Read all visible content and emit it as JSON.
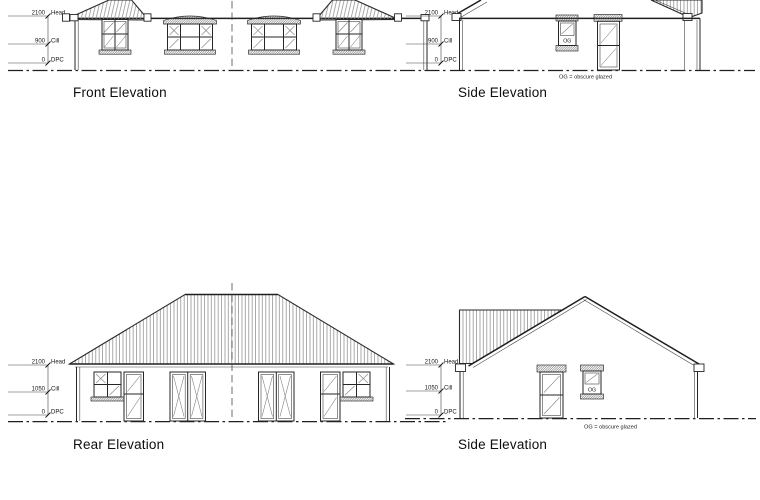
{
  "views": {
    "front": {
      "label": "Front Elevation",
      "dims": {
        "head": {
          "v": "2100",
          "n": "Head"
        },
        "cill": {
          "v": "900",
          "n": "Cill"
        },
        "dpc": {
          "v": "0",
          "n": "DPC"
        }
      }
    },
    "side_top": {
      "label": "Side Elevation",
      "dims": {
        "head": {
          "v": "2100",
          "n": "Head"
        },
        "cill": {
          "v": "900",
          "n": "Cill"
        },
        "dpc": {
          "v": "0",
          "n": "DPC"
        }
      },
      "og": "OG",
      "note": "OG = obscure glazed"
    },
    "rear": {
      "label": "Rear Elevation",
      "dims": {
        "head": {
          "v": "2100",
          "n": "Head"
        },
        "cill": {
          "v": "1050",
          "n": "Cill"
        },
        "dpc": {
          "v": "0",
          "n": "DPC"
        }
      }
    },
    "side_bottom": {
      "label": "Side Elevation",
      "dims": {
        "head": {
          "v": "2100",
          "n": "Head"
        },
        "cill": {
          "v": "1050",
          "n": "Cill"
        },
        "dpc": {
          "v": "0",
          "n": "DPC"
        }
      },
      "og": "OG",
      "note": "OG = obscure glazed"
    }
  },
  "colors": {
    "line": "#262626",
    "roof_hatch": "#8d8d8d",
    "masonry_hatch": "#5f5f5f",
    "paper": "#ffffff"
  }
}
